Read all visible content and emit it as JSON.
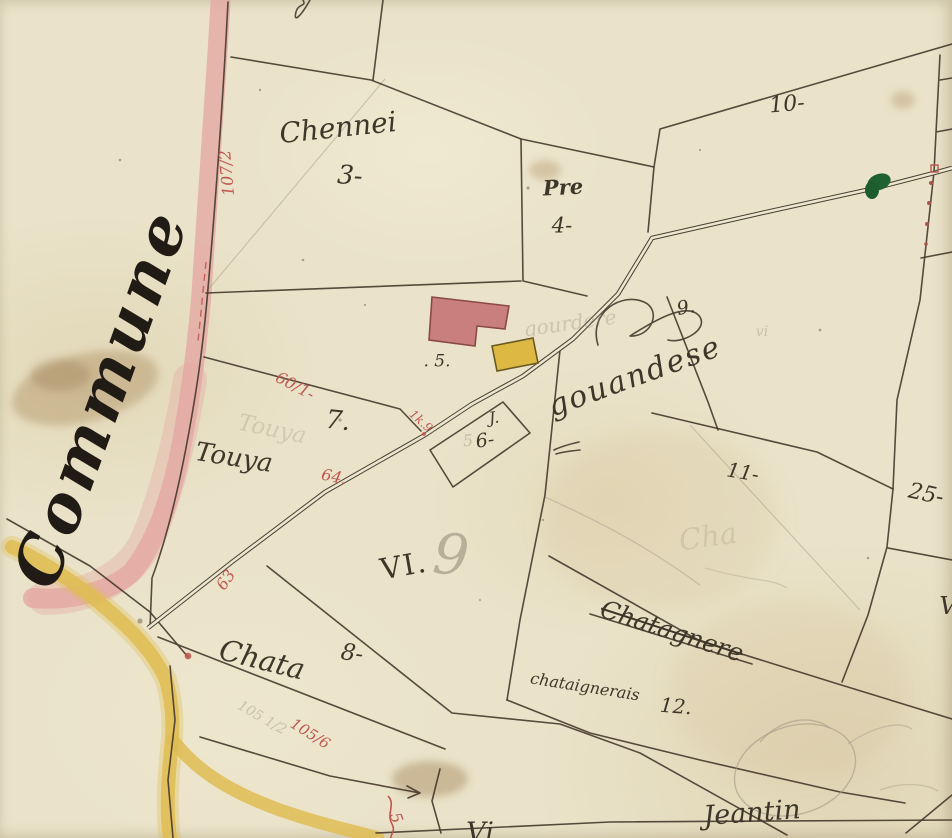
{
  "map": {
    "title": "Commune",
    "labels": {
      "commune": "Commune",
      "chennei": "Chennei",
      "chennei_num": "3-",
      "pre": "Pre",
      "pre_num": "4-",
      "building_num": ". 5.",
      "p10": "10-",
      "p11": "11-",
      "p25": "25-",
      "p7": "7.",
      "touya": "Touya",
      "j6_letter": "J.",
      "j6_num": "6-",
      "gouandese": "gouandese",
      "gouandese_num": "9.",
      "vi": "VI.",
      "chata": "Chata",
      "p8": "8-",
      "chatagnere": "Chatagnere",
      "chataignerais": "chataignerais",
      "p12": "12.",
      "jeantin": "Jeantin",
      "vi_bottom": "Vi",
      "v_right": "V"
    },
    "red": {
      "r107": "107/2",
      "r60": "60/1-",
      "r1k9": "1k.9",
      "r64": "64.",
      "r63": "63",
      "r105": "105/6",
      "r5": "5"
    },
    "pencil": {
      "touya": "Touya",
      "gourdere": "gourdere",
      "vi_small": "vi",
      "nine": "9",
      "five": "5",
      "p105": "105 1/2",
      "cha": "Cha"
    },
    "colors": {
      "paper": "#eae3c9",
      "ink": "#46392c",
      "red_annotation": "#bf5751",
      "road_pink": "#e4a8a2",
      "path_yellow": "#dfbc52",
      "building_red": "#c9807d",
      "building_yellow": "#ddb944",
      "green_mark": "#20622f",
      "pencil": "#8f8672"
    }
  }
}
